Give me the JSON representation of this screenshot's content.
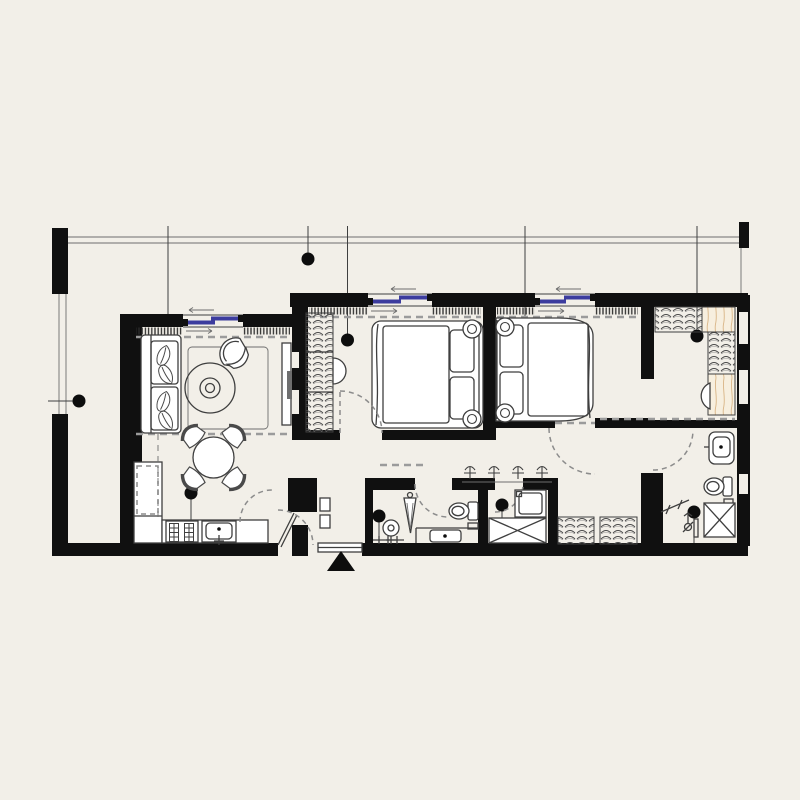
{
  "document": {
    "kind": "architectural floor plan",
    "style": "black walls on cream background, line furniture symbols",
    "visible_text_labels": [],
    "entrance_marker": "solid black triangle pointing up at main entry door"
  },
  "colors": {
    "bg": "#f2efe8",
    "wall": "#101010",
    "line": "#3f3f3f",
    "dash": "#9b9b9b",
    "blue": "#3c3c9e",
    "wood-line": "#d9b586",
    "wood-fill": "#f7efdf",
    "fx": "#ffffff"
  },
  "plan": {
    "rooms": [
      {
        "name": "terrace",
        "position": "wraps top and left side",
        "features": [
          "thin boundary lines",
          "railing",
          "black wall piers"
        ]
      },
      {
        "name": "living-dining-room",
        "furniture": [
          "two-seat sofa with leaf cushions",
          "round coffee table on rug",
          "barrel armchair",
          "tv-console",
          "round dining table with 4 chairs"
        ]
      },
      {
        "name": "kitchen",
        "furniture": [
          "L-shaped counter",
          "4-plate stove",
          "sink",
          "dashed wall cabinets"
        ]
      },
      {
        "name": "bedroom-1",
        "furniture": [
          "double bed, head to east wall",
          "two pendant lamps",
          "wardrobe with hanging clothes",
          "vanity stool"
        ]
      },
      {
        "name": "bedroom-2",
        "furniture": [
          "double bed, head to west wall",
          "two pendant lamps"
        ]
      },
      {
        "name": "dressing-room",
        "furniture": [
          "wardrobes on north and east walls",
          "dressing desk with half-round chair",
          "hall closets"
        ]
      },
      {
        "name": "entry-vestibule",
        "furniture": [
          "entry door",
          "shoe cabinet"
        ]
      },
      {
        "name": "guest-bathroom",
        "furniture": [
          "pedestal basin",
          "water-heater column",
          "vanity counter with basin",
          "toilet",
          "towel rail"
        ]
      },
      {
        "name": "laundry-room",
        "furniture": [
          "washing machine",
          "shower tray (X)",
          "coat hooks row"
        ]
      },
      {
        "name": "ensuite-bathroom",
        "furniture": [
          "vanity basin",
          "toilet",
          "shower tray (X)",
          "towel rail",
          "shower valve"
        ]
      }
    ],
    "windows": {
      "count": 3,
      "type": "sliding, blue glazing with direction arrows",
      "locations": [
        "living room north",
        "bedroom-1 north",
        "bedroom-2 north"
      ]
    },
    "ceiling_lights": {
      "count": 11,
      "symbol": "black dot with thin leader line"
    },
    "door_swings": {
      "count": 8,
      "symbol": "gray dashed quarter arcs"
    }
  }
}
